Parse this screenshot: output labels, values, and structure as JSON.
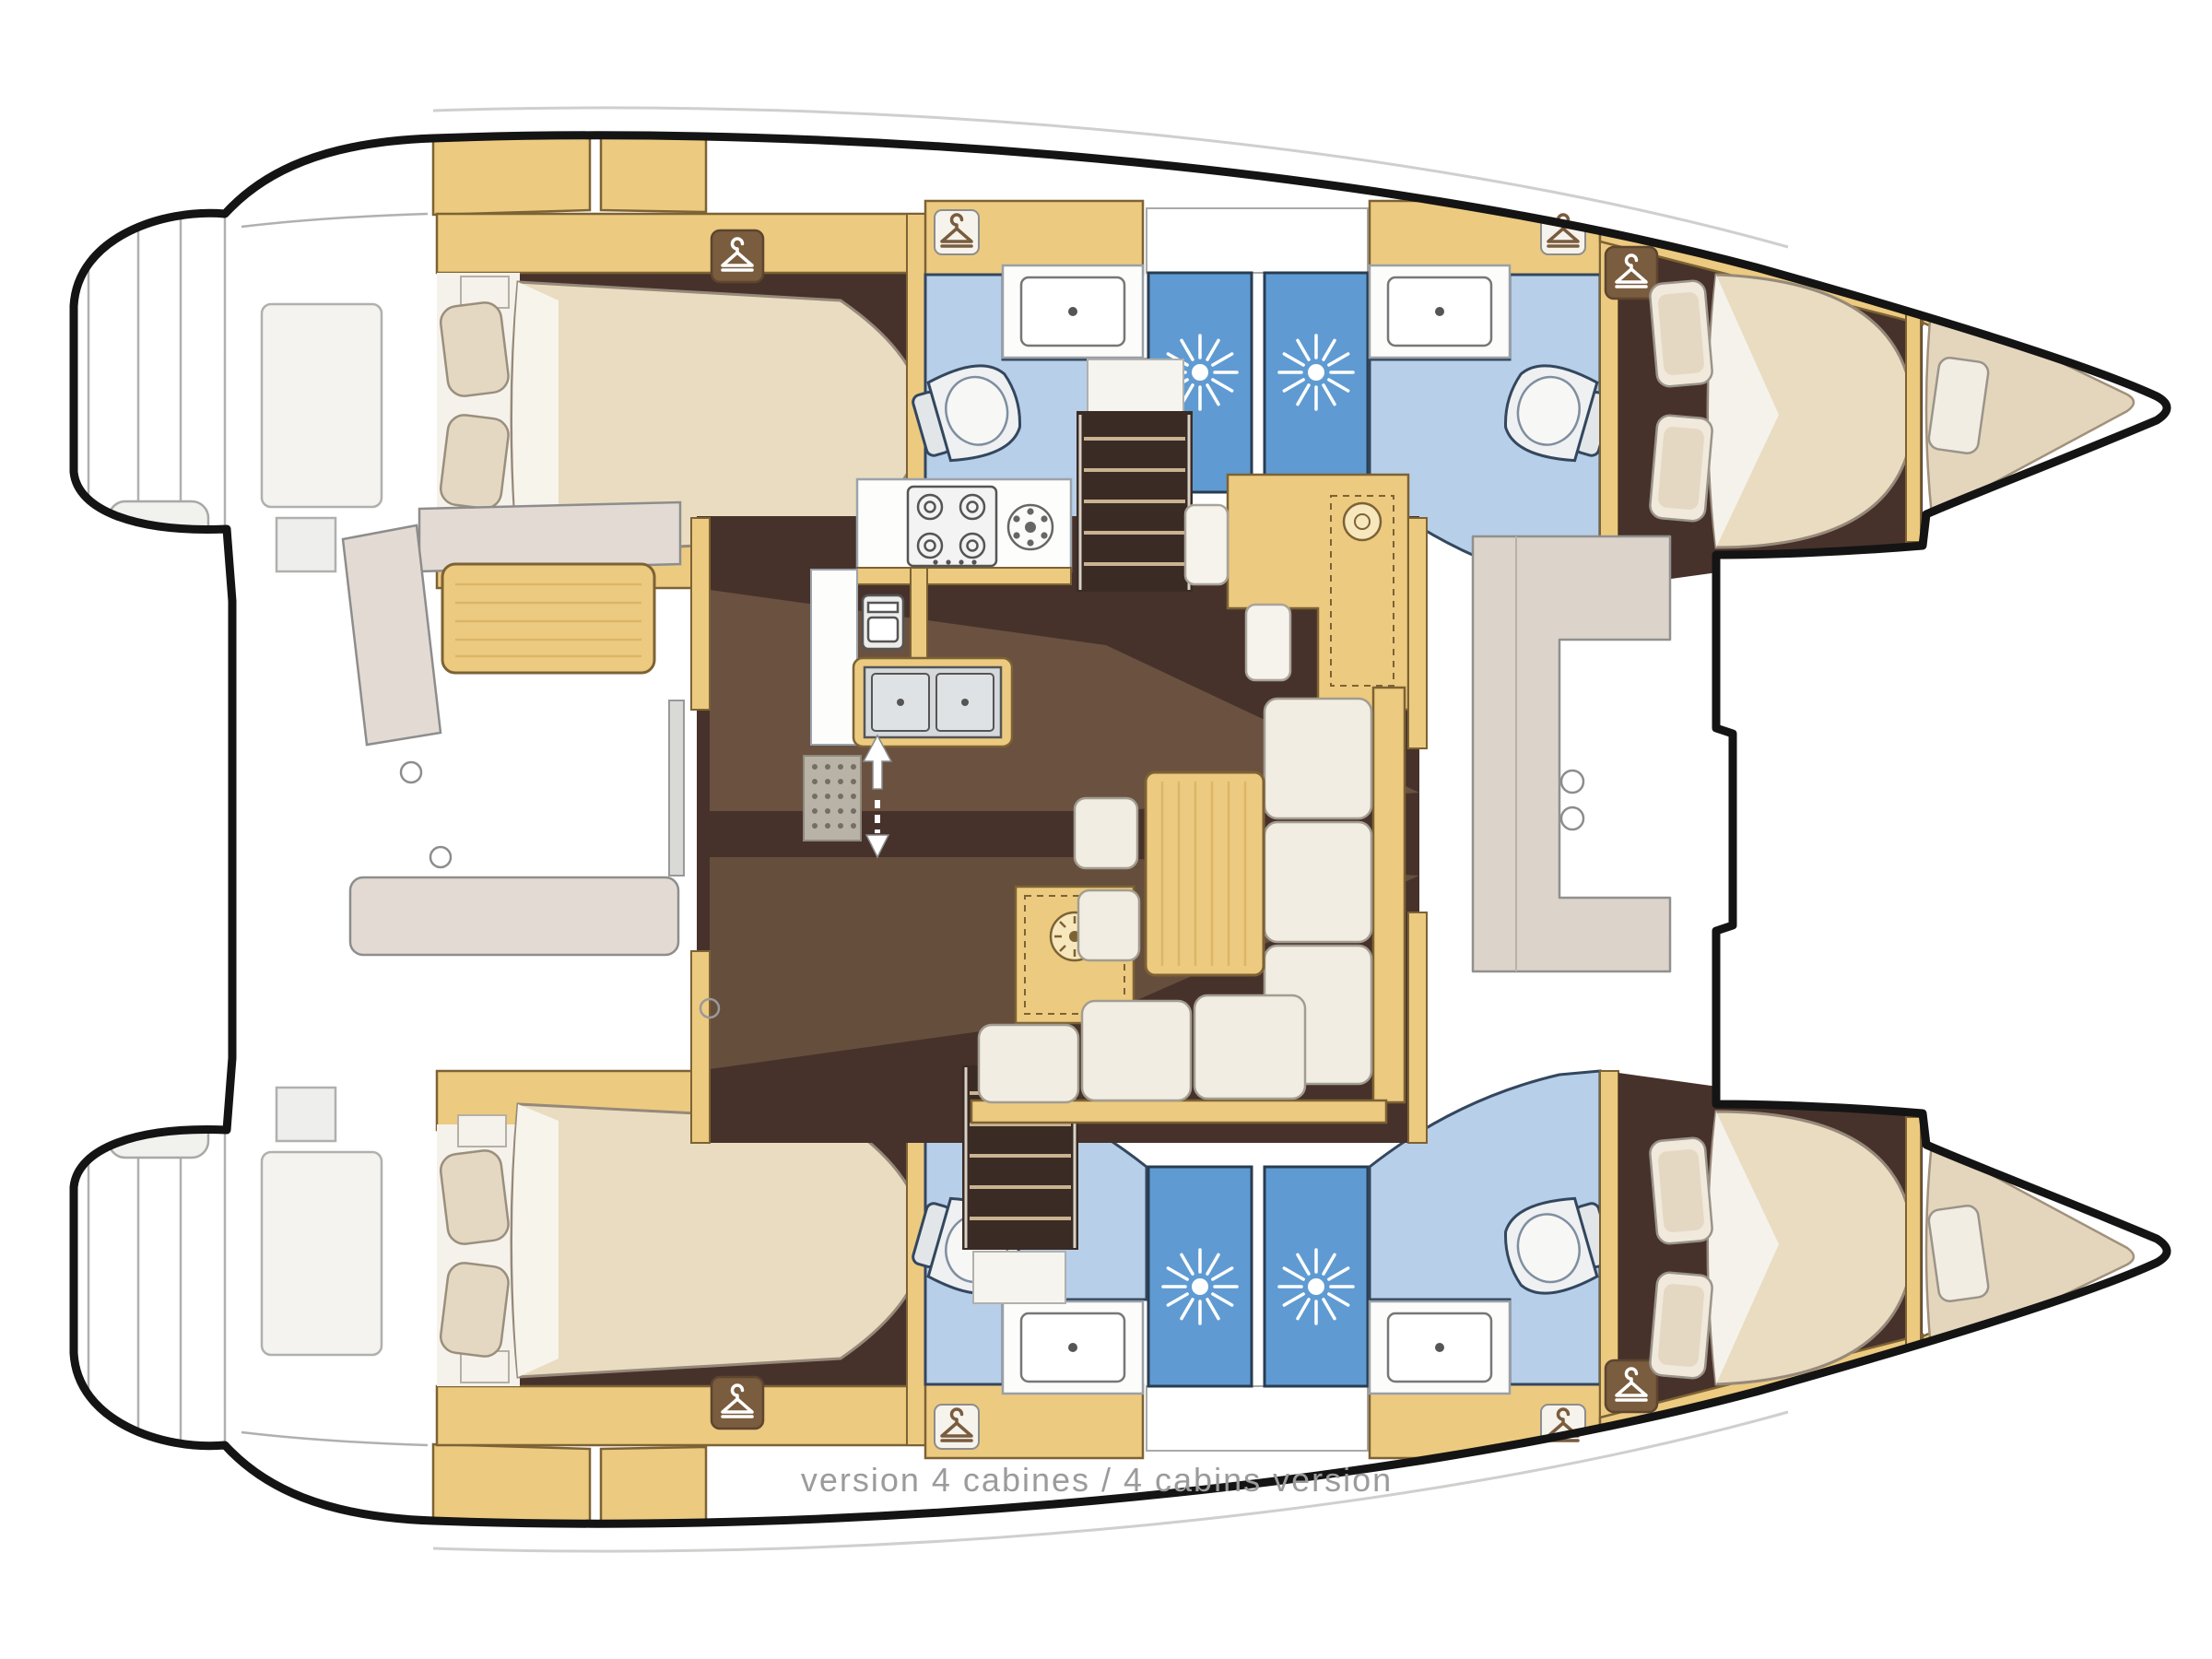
{
  "caption": {
    "text_full": "version 4 cabines / 4 cabins version",
    "text_fr": "version 4 cabines",
    "text_en": "4 cabins version"
  },
  "diagram": {
    "type": "boat-floor-plan",
    "subject": "Sailing catamaran interior layout, top-down view, bow pointing right",
    "layout_version": "4 cabins",
    "counts": {
      "cabins": 4,
      "shower_stalls": 4,
      "toilets": 4,
      "sinks": 4,
      "wardrobes": 8,
      "companionways": 2
    },
    "rooms": {
      "port_hull": [
        "aft double cabin",
        "aft head (toilet + sink)",
        "shower stall",
        "forward head (toilet + sink)",
        "forward double cabin",
        "forepeak berth"
      ],
      "starboard_hull": [
        "aft double cabin",
        "aft head (toilet + sink)",
        "shower stall",
        "forward head (toilet + sink)",
        "forward double cabin",
        "forepeak berth"
      ],
      "bridgedeck": [
        "aft cockpit with benches and table",
        "salon with L-sofa and table",
        "galley with 4-burner stove, oven and double sink",
        "navigation station",
        "forward cockpit with C-bench"
      ]
    },
    "icons": [
      "wardrobe-hanger-icon",
      "shower-spray-icon",
      "toilet-icon",
      "sink-icon",
      "stove-burners-icon",
      "round-burner-icon",
      "oven-icon",
      "double-sink-icon",
      "stairs-icon",
      "up-down-arrows-icon",
      "cupholder-icon",
      "vent-circle-icon"
    ],
    "colors": {
      "outline": "#141414",
      "deck_white": "#ffffff",
      "line_gray": "#b3b3b0",
      "wood": "#ecca80",
      "wood_edge": "#7d6234",
      "wood_grain": "#dcb567",
      "floor_brown": "#46322b",
      "overlay_tan": "#96785a",
      "bath_blue": "#b7cfe8",
      "shower_blue": "#5f9bd2",
      "bath_edge": "#33475e",
      "cushion_cream": "#f2ede3",
      "bench_taupe": "#dcd3ca",
      "mattress": "#e9dcc0",
      "pillow": "#e4d8c2",
      "stainless": "#d6d9db",
      "wardrobe_brown": "#7a5c3e",
      "caption_gray": "#9b9b9b"
    }
  }
}
